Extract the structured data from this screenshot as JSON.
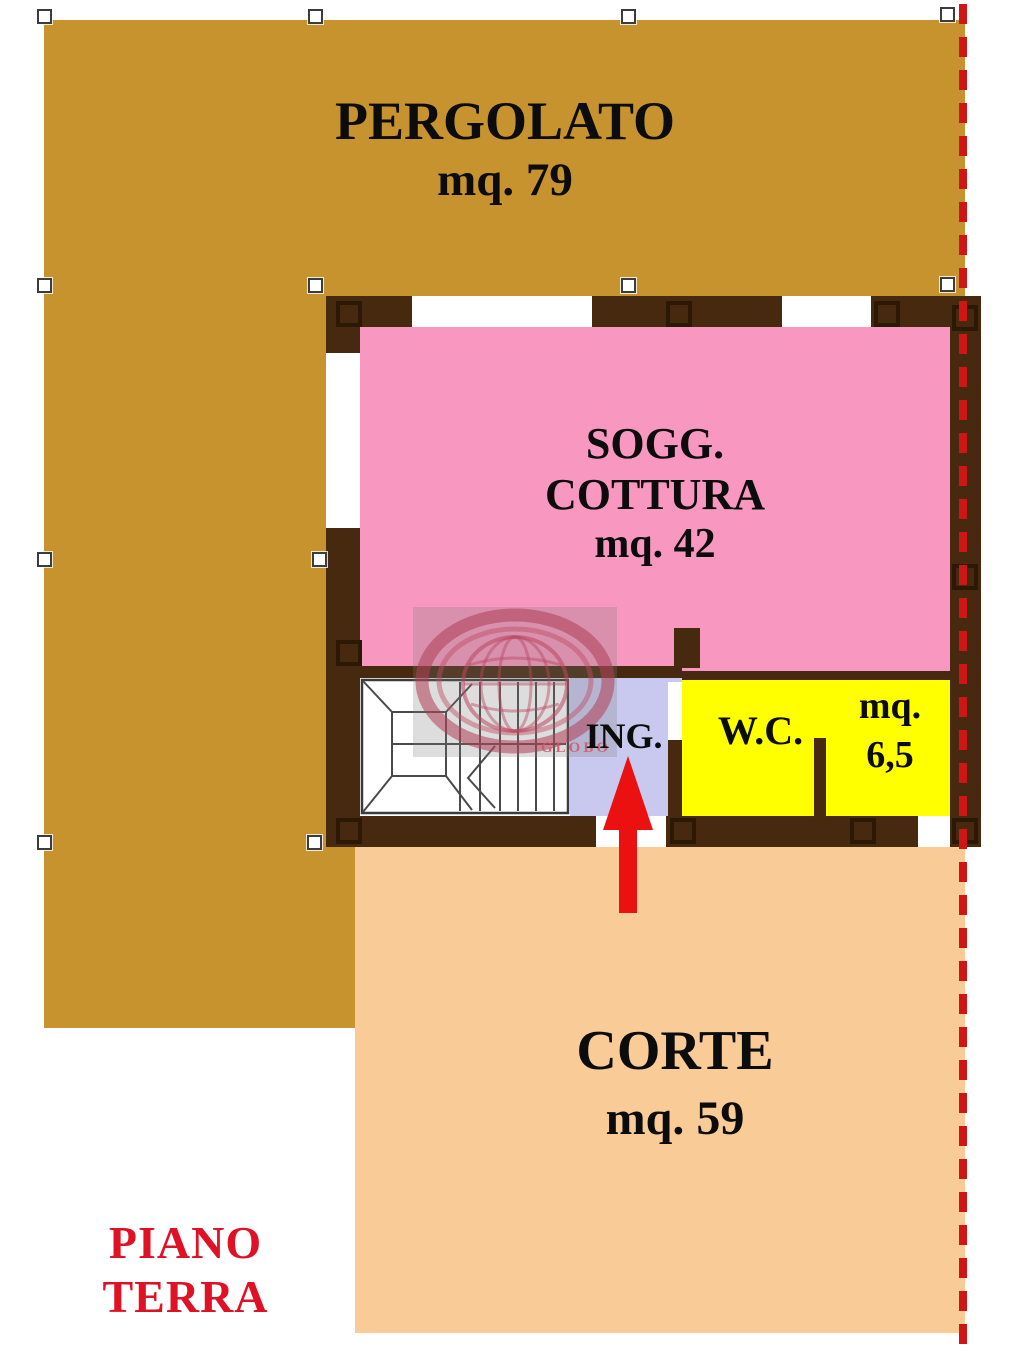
{
  "plan": {
    "floor_label": {
      "line1": "PIANO",
      "line2": "TERRA"
    },
    "rooms": {
      "pergolato": {
        "name": "PERGOLATO",
        "area": "mq. 79"
      },
      "sogg_cottura": {
        "name_line1": "SOGG.",
        "name_line2": "COTTURA",
        "area": "mq. 42"
      },
      "ingresso": {
        "name": "ING."
      },
      "wc": {
        "name": "W.C.",
        "area_line1": "mq.",
        "area_line2": "6,5"
      },
      "corte": {
        "name": "CORTE",
        "area": "mq. 59"
      }
    },
    "watermark": {
      "text": "GLOBO"
    },
    "colors": {
      "pergolato": "#C6932F",
      "sogg_cottura": "#F897BF",
      "ingresso": "#C9C9F0",
      "wc": "#FFFF00",
      "corte": "#F9CB97",
      "wall": "#47290F",
      "boundary_dash": "#CE1616",
      "entrance_arrow": "#EB1111",
      "floor_label_text": "#DF1225"
    }
  }
}
